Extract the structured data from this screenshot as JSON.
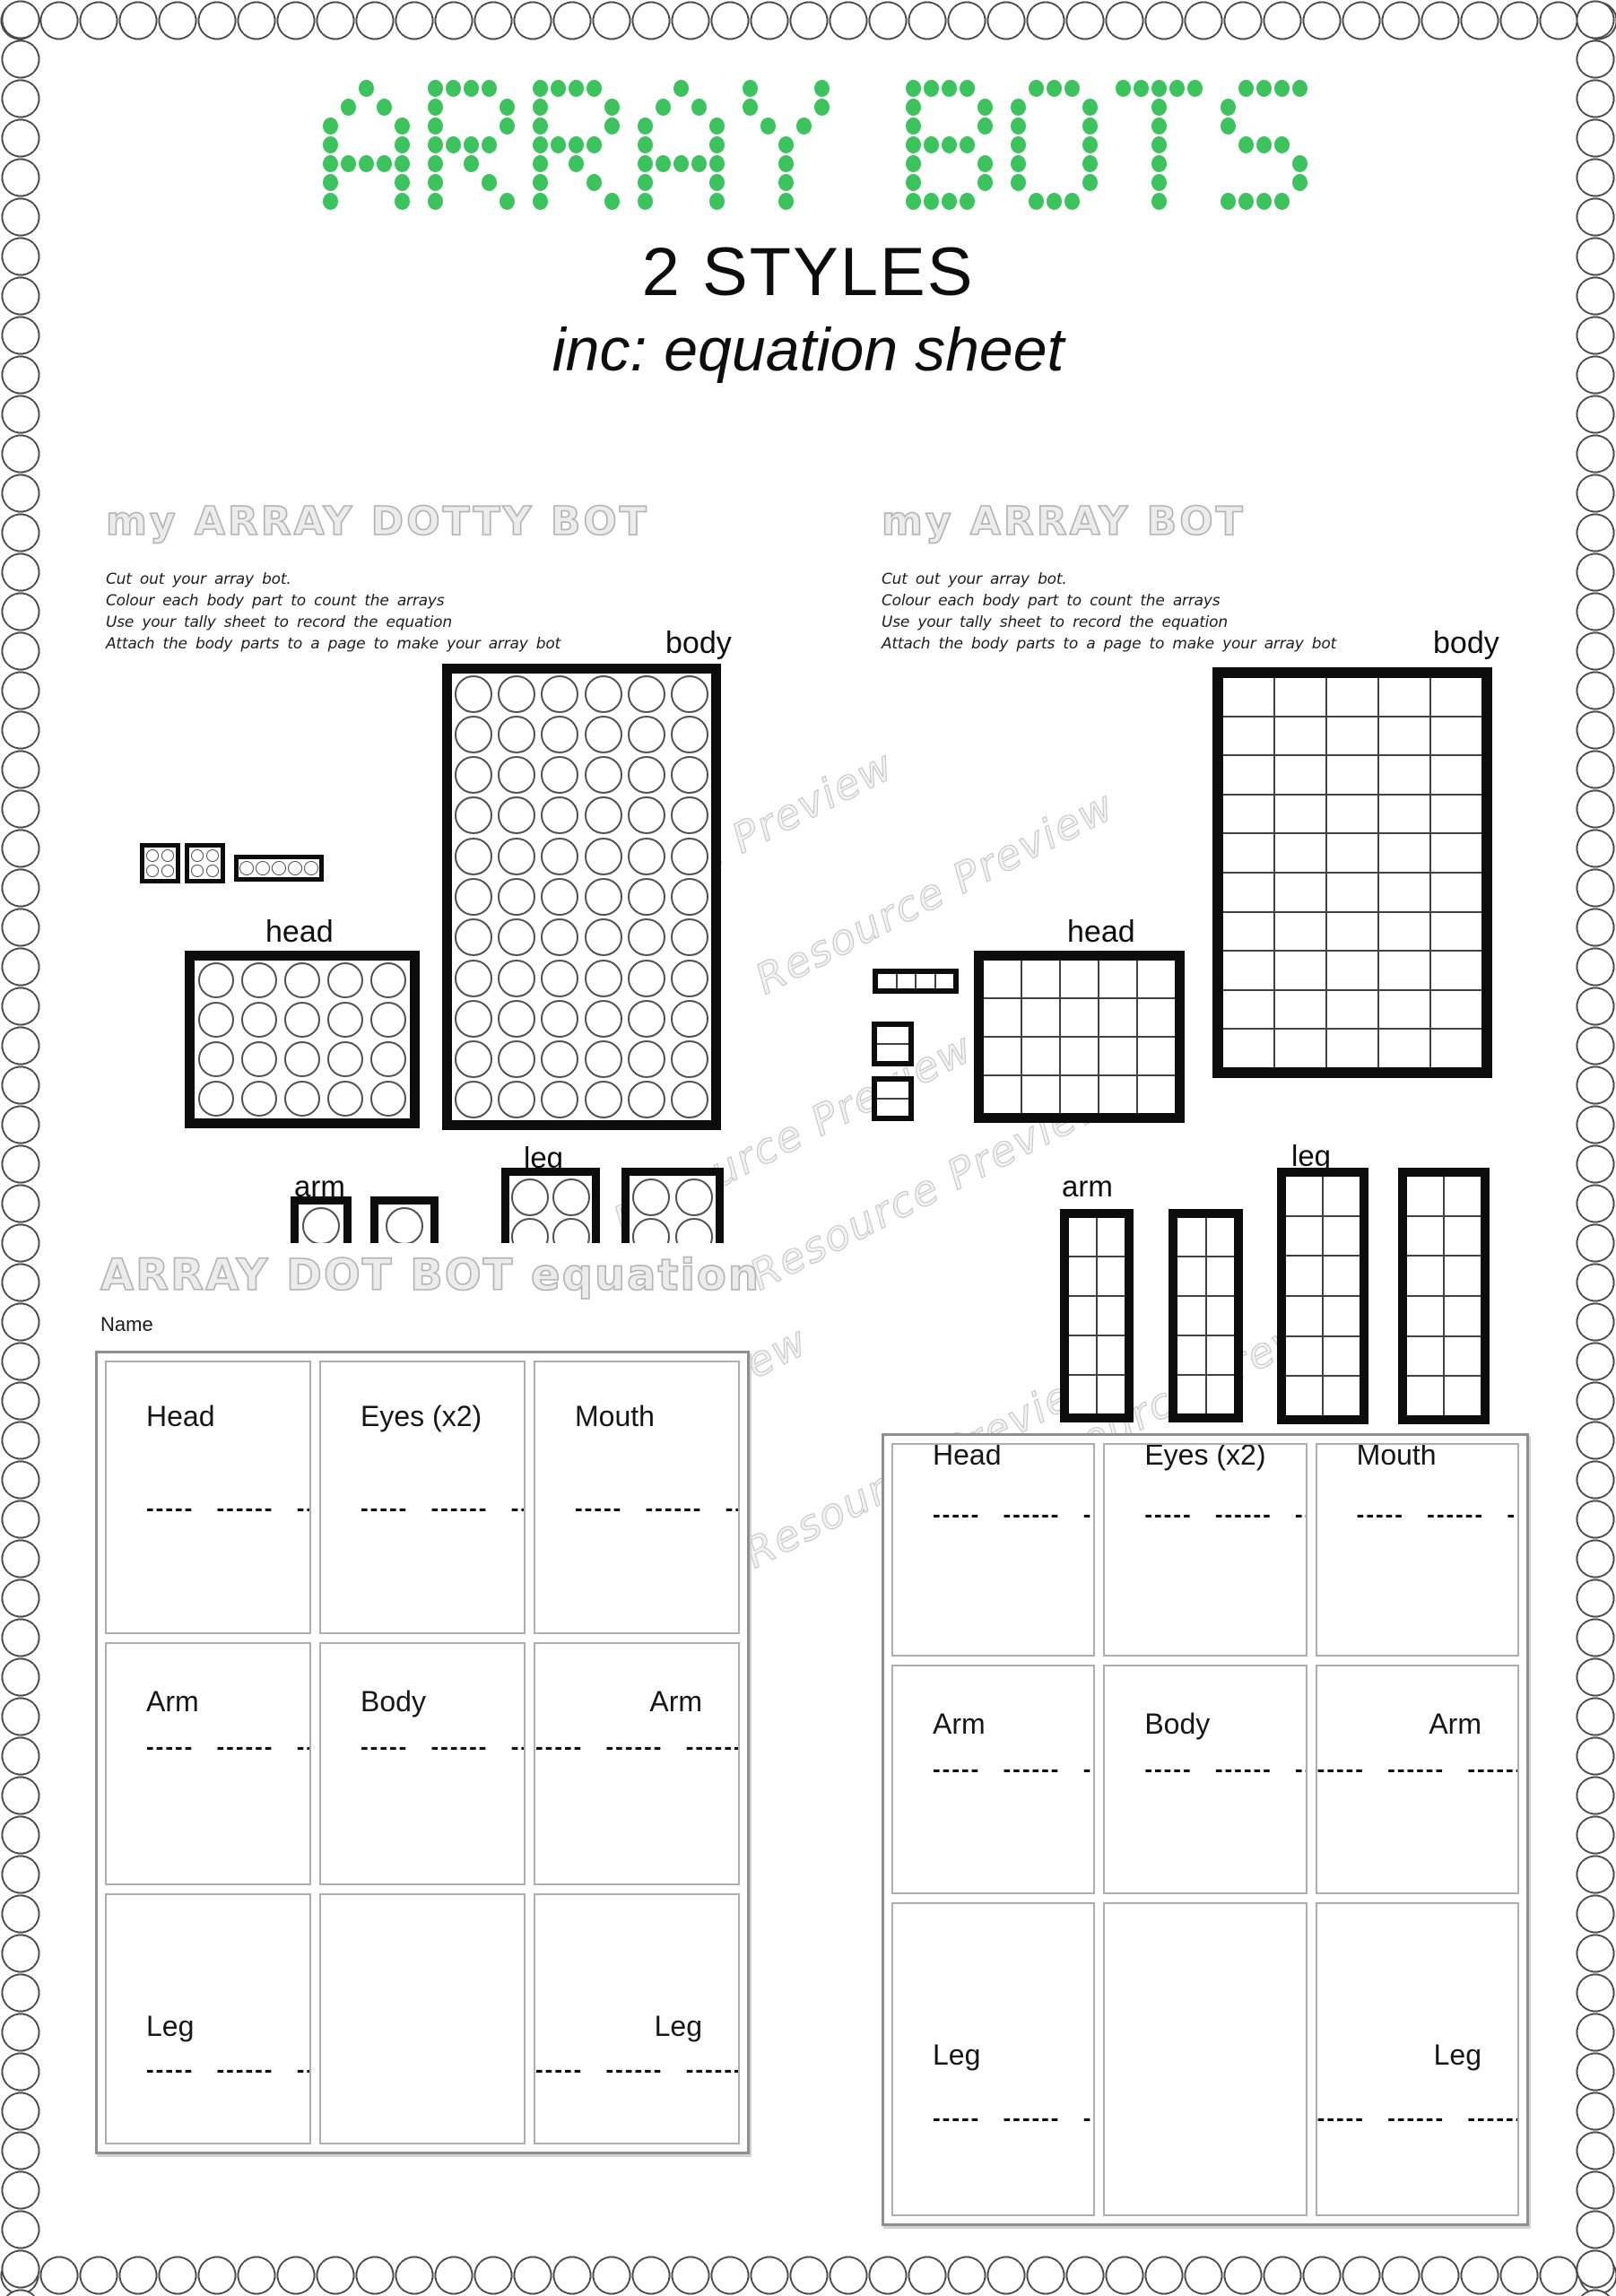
{
  "page": {
    "title": "ARRAY BOTS",
    "subtitle": "2 STYLES",
    "subtitle2": "inc: equation sheet",
    "watermark": "Resource Preview",
    "accent_green": "#3cc35e"
  },
  "left_sheet": {
    "title": "my ARRAY DOTTY BOT",
    "instructions": [
      "Cut out your array bot.",
      "Colour each body part to count the arrays",
      "Use your tally sheet to record the equation",
      "Attach the body parts to a page to make your array bot"
    ],
    "body_label": "body",
    "head_label": "head",
    "arm_label": "arm",
    "leg_label": "leg",
    "grids": {
      "body": {
        "rows": 11,
        "cols": 6,
        "shape": "circle"
      },
      "head": {
        "rows": 4,
        "cols": 5,
        "shape": "circle"
      },
      "eye1": {
        "rows": 2,
        "cols": 2,
        "shape": "circle"
      },
      "eye2": {
        "rows": 2,
        "cols": 2,
        "shape": "circle"
      },
      "mouth": {
        "rows": 1,
        "cols": 5,
        "shape": "circle"
      },
      "arm1": {
        "rows": 1,
        "cols": 1,
        "shape": "circle"
      },
      "arm2": {
        "rows": 1,
        "cols": 1,
        "shape": "circle"
      },
      "leg1": {
        "rows": 2,
        "cols": 2,
        "shape": "circle"
      },
      "leg2": {
        "rows": 2,
        "cols": 2,
        "shape": "circle"
      }
    }
  },
  "right_sheet": {
    "title": "my ARRAY BOT",
    "instructions": [
      "Cut out your array bot.",
      "Colour each body part to count the arrays",
      "Use your tally sheet to record the equation",
      "Attach the body parts to a page to make your array bot"
    ],
    "body_label": "body",
    "head_label": "head",
    "arm_label": "arm",
    "leg_label": "leg",
    "grids": {
      "body": {
        "rows": 10,
        "cols": 5,
        "shape": "square"
      },
      "head": {
        "rows": 4,
        "cols": 5,
        "shape": "square"
      },
      "mouth": {
        "rows": 1,
        "cols": 4,
        "shape": "square"
      },
      "eye1": {
        "rows": 2,
        "cols": 1,
        "shape": "square"
      },
      "eye2": {
        "rows": 2,
        "cols": 1,
        "shape": "square"
      },
      "arm1": {
        "rows": 5,
        "cols": 2,
        "shape": "square"
      },
      "arm2": {
        "rows": 5,
        "cols": 2,
        "shape": "square"
      },
      "leg1": {
        "rows": 6,
        "cols": 2,
        "shape": "square"
      },
      "leg2": {
        "rows": 6,
        "cols": 2,
        "shape": "square"
      }
    }
  },
  "equation_sheet": {
    "title": "ARRAY DOT BOT equation",
    "name_label": "Name",
    "dash_line": "----- ------ ------",
    "cells": [
      {
        "label": "Head",
        "align": "left",
        "dashes": true
      },
      {
        "label": "Eyes (x2)",
        "align": "left",
        "dashes": true
      },
      {
        "label": "Mouth",
        "align": "left",
        "dashes": true
      },
      {
        "label": "Arm",
        "align": "left",
        "dashes": true
      },
      {
        "label": "Body",
        "align": "left",
        "dashes": true
      },
      {
        "label": "Arm",
        "align": "right",
        "dashes": true
      },
      {
        "label": "Leg",
        "align": "left",
        "dashes": true
      },
      {
        "label": "",
        "align": "left",
        "dashes": false
      },
      {
        "label": "Leg",
        "align": "right",
        "dashes": true
      }
    ]
  }
}
